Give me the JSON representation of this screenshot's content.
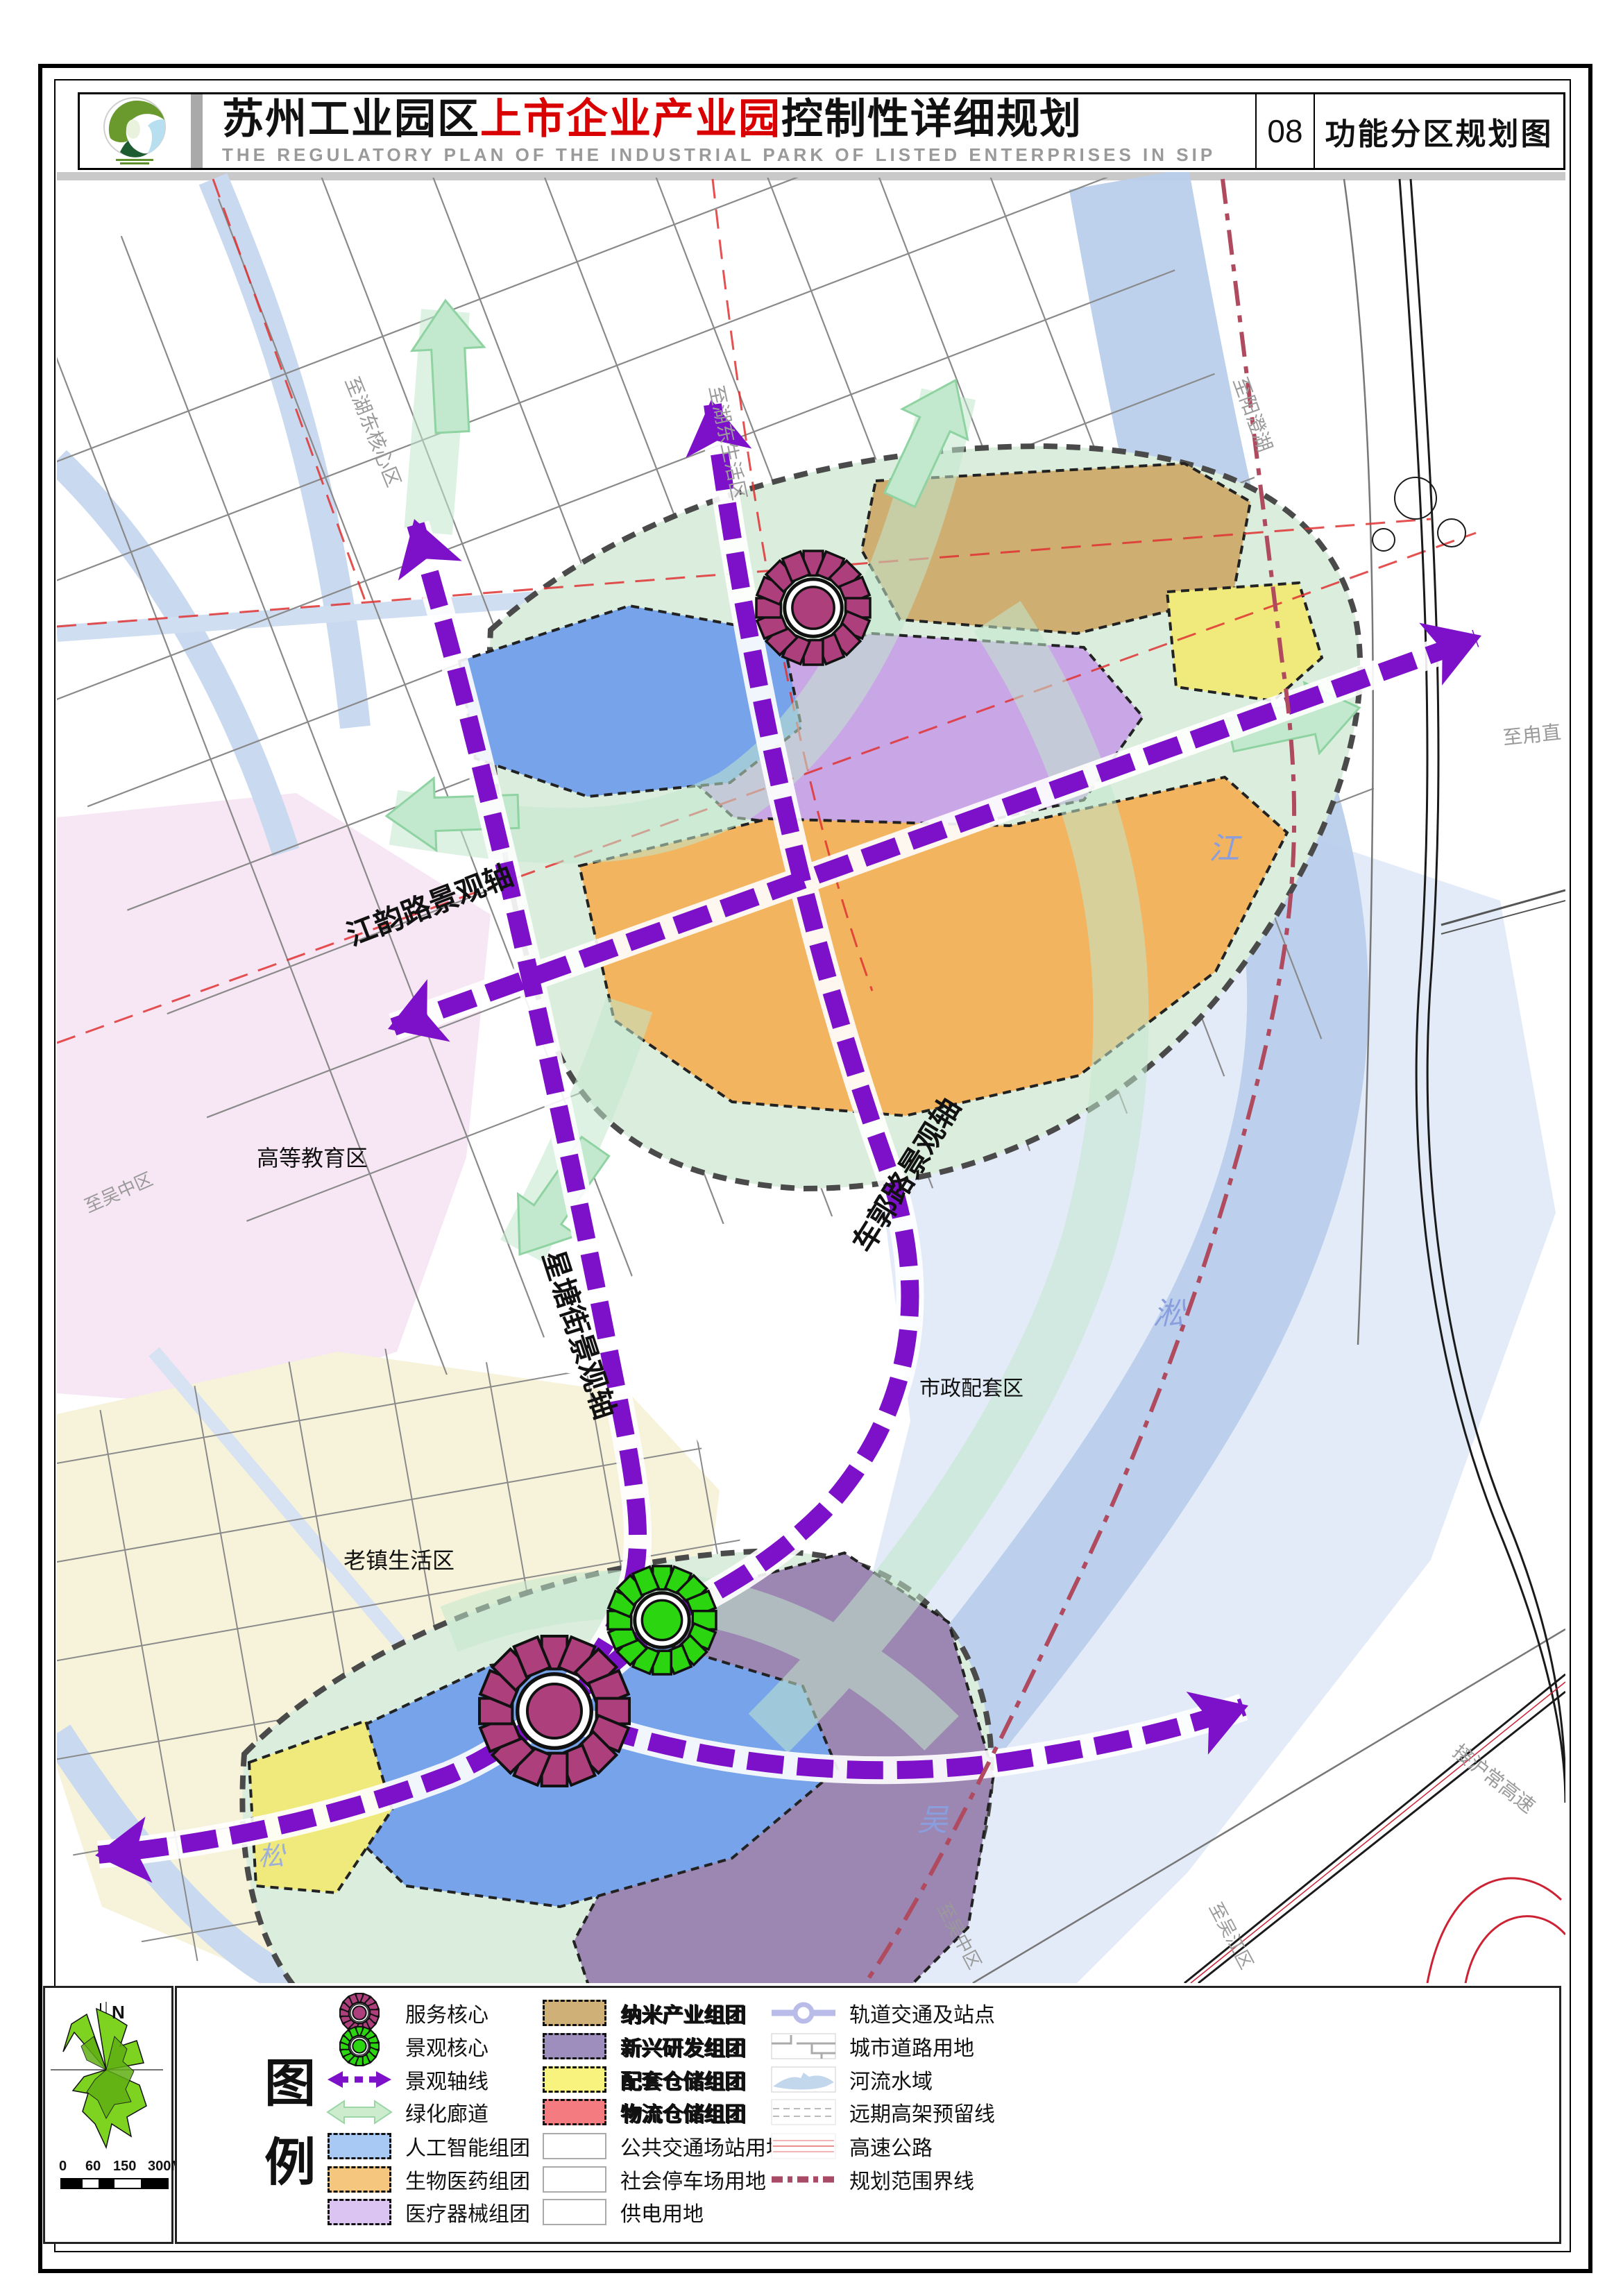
{
  "header": {
    "title_black1": "苏州工业园区",
    "title_red": "上市企业产业园",
    "title_black2": "控制性详细规划",
    "subtitle": "THE REGULATORY PLAN OF THE INDUSTRIAL PARK OF LISTED ENTERPRISES IN SIP",
    "sheet_no": "08",
    "sheet_name": "功能分区规划图"
  },
  "map": {
    "labels": [
      "江韵路景观轴",
      "星塘街景观轴",
      "车郭路景观轴",
      "高等教育区",
      "老镇生活区",
      "市政配套区",
      "至湖东核心区",
      "至湖东生活区",
      "至阳澄湖",
      "至甪直",
      "至吴中区",
      "至吴中区",
      "至吴江区",
      "接沪常高速",
      "吴",
      "淞",
      "江",
      "松"
    ]
  },
  "compass": {
    "north": "N"
  },
  "scalebar": {
    "ticks": [
      "0",
      "60",
      "150",
      "300M"
    ]
  },
  "legend": {
    "title_chars": [
      "图",
      "例"
    ],
    "col1": [
      {
        "label": "服务核心"
      },
      {
        "label": "景观核心"
      },
      {
        "label": "景观轴线"
      },
      {
        "label": "绿化廊道"
      },
      {
        "label": "人工智能组团"
      },
      {
        "label": "生物医药组团"
      },
      {
        "label": "医疗器械组团"
      }
    ],
    "col2": [
      {
        "label": "纳米产业组团"
      },
      {
        "label": "新兴研发组团"
      },
      {
        "label": "配套仓储组团"
      },
      {
        "label": "物流仓储组团"
      },
      {
        "label": "公共交通场站用地"
      },
      {
        "label": "社会停车场用地"
      },
      {
        "label": "供电用地"
      }
    ],
    "col3": [
      {
        "label": "轨道交通及站点"
      },
      {
        "label": "城市道路用地"
      },
      {
        "label": "河流水域"
      },
      {
        "label": "远期高架预留线"
      },
      {
        "label": "高速公路"
      },
      {
        "label": "规划范围界线"
      }
    ],
    "colors": {
      "axis_purple": "#7d10c9",
      "corridor_green": "#c2e8cd",
      "service_core": "#ad3f7d",
      "landscape_core": "#2bd610",
      "ai_blue": "#a9c9f5",
      "biopharma_orange": "#f5c77e",
      "device_purple": "#dcc4f2",
      "nano_tan": "#cfb177",
      "rd_purple": "#9e8ebe",
      "support_yellow": "#f7f37e",
      "logistics_red": "#f47c80",
      "water": "#c3d7ee",
      "boundary_red": "#b04a5e"
    }
  }
}
